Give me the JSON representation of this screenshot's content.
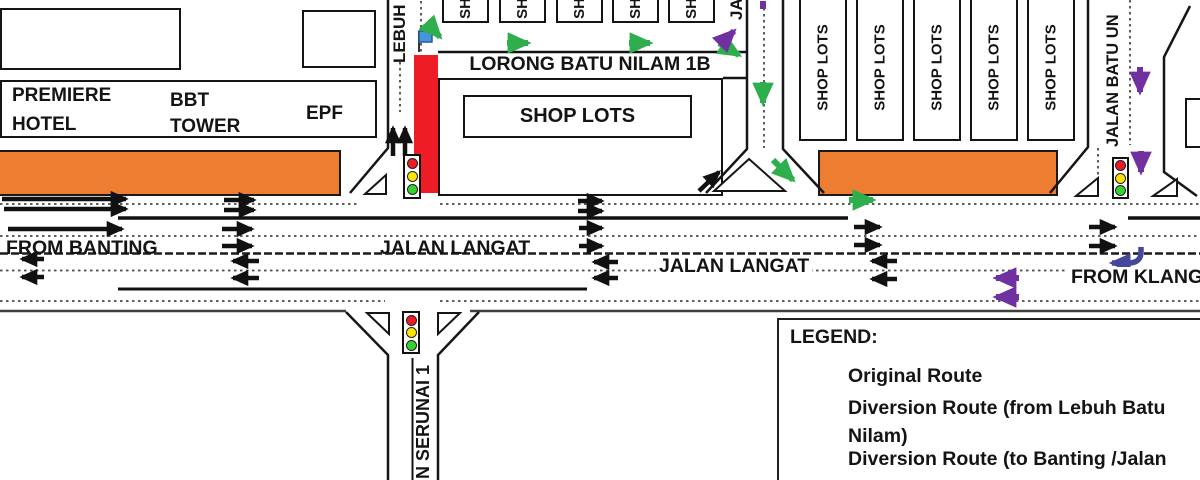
{
  "colors": {
    "original_route": "#111111",
    "diversion_green": "#2FAE4E",
    "diversion_purple": "#7030A0",
    "uturn_navy": "#45479B",
    "closure_red": "#EE1C25",
    "building_orange": "#ED7D31",
    "flag_blue": "#4596D8",
    "traffic_red": "#ED1C24",
    "traffic_yellow": "#FFE600",
    "traffic_green": "#35D331"
  },
  "buildings": {
    "premiere_hotel": {
      "line1": "PREMIERE",
      "line2": "HOTEL"
    },
    "bbt_tower": {
      "line1": "BBT",
      "line2": "TOWER"
    },
    "epf": "EPF",
    "center_shop_lots": "SHOP LOTS",
    "small_shop_labels": [
      "SH",
      "SH",
      "SH",
      "SH",
      "SH"
    ],
    "right_shop_labels": [
      "SHOP LOTS",
      "SHOP LOTS",
      "SHOP LOTS",
      "SHOP LOTS",
      "SHOP LOTS"
    ]
  },
  "roads": {
    "lebuh": "LEBUH",
    "lorong_batu_nilam": "LORONG BATU NILAM 1B",
    "ja": "JA",
    "jalan_batu_un": "JALAN BATU UN",
    "jalan_langat_west": "JALAN LANGAT",
    "jalan_langat_east": "JALAN LANGAT",
    "from_banting": "FROM BANTING",
    "from_klang": "FROM KLANG",
    "serunai": "N SERUNAI 1"
  },
  "legend": {
    "title": "LEGEND:",
    "items": [
      {
        "label": "Original Route",
        "color": "#111111"
      },
      {
        "label": "Diversion Route (from Lebuh Batu Nilam)",
        "color": "#2FAE4E"
      },
      {
        "label": "Diversion Route (to Banting /Jalan",
        "color": "#7030A0"
      }
    ]
  }
}
